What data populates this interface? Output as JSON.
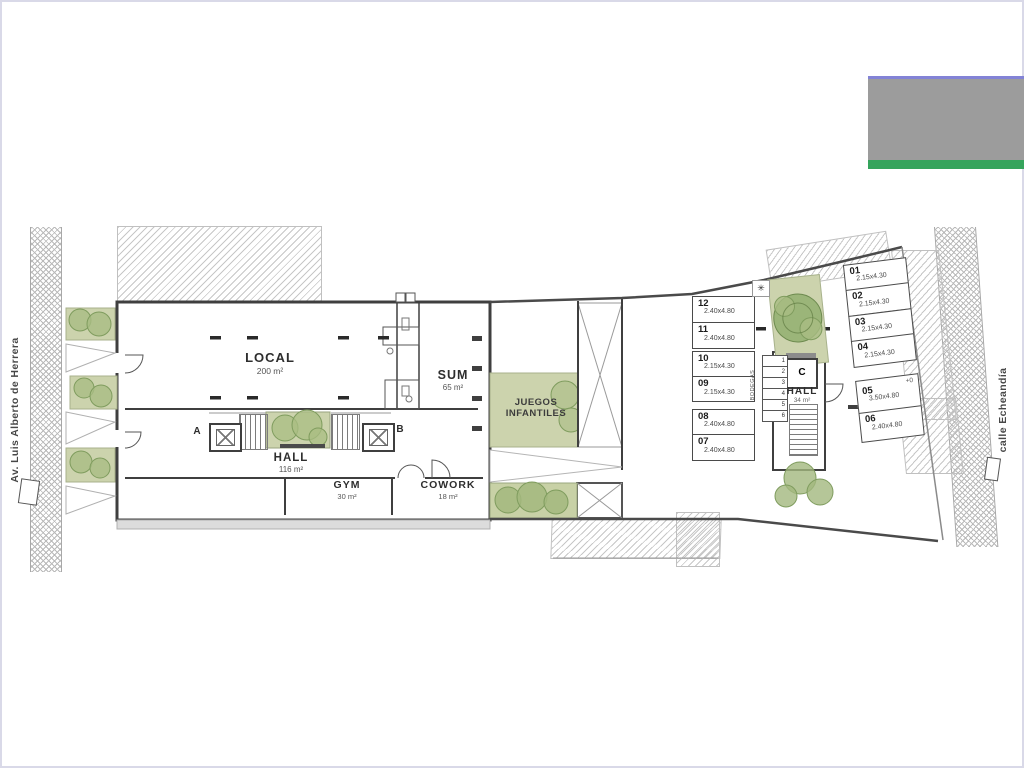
{
  "plan": {
    "streets": {
      "left_label": "Av. Luis Alberto de Herrera",
      "right_label": "calle Echeandía"
    },
    "rooms": {
      "local": {
        "label": "LOCAL",
        "area": "200 m²"
      },
      "sum": {
        "label": "SUM",
        "area": "65 m²"
      },
      "hall_main": {
        "label": "HALL",
        "area": "116 m²"
      },
      "gym": {
        "label": "GYM",
        "area": "30 m²"
      },
      "cowork": {
        "label": "COWORK",
        "area": "18 m²"
      },
      "playground": {
        "line1": "JUEGOS",
        "line2": "INFANTILES"
      },
      "hall_right": {
        "label": "HALL",
        "area": "34 m²"
      }
    },
    "elevators": {
      "a": "A",
      "b": "B",
      "c": "C"
    },
    "parking_left": [
      {
        "num": "12",
        "dim": "2.40x4.80"
      },
      {
        "num": "11",
        "dim": "2.40x4.80"
      },
      {
        "num": "10",
        "dim": "2.15x4.30"
      },
      {
        "num": "09",
        "dim": "2.15x4.30"
      },
      {
        "num": "08",
        "dim": "2.40x4.80"
      },
      {
        "num": "07",
        "dim": "2.40x4.80"
      }
    ],
    "parking_right": [
      {
        "num": "01",
        "dim": "2.15x4.30"
      },
      {
        "num": "02",
        "dim": "2.15x4.30"
      },
      {
        "num": "03",
        "dim": "2.15x4.30"
      },
      {
        "num": "04",
        "dim": "2.15x4.30"
      },
      {
        "num": "05",
        "dim": "3.50x4.80",
        "level": "+0"
      },
      {
        "num": "06",
        "dim": "2.40x4.80"
      }
    ],
    "storage": {
      "label": "BODEGAS",
      "units": [
        "1",
        "2",
        "3",
        "4",
        "5",
        "6"
      ]
    },
    "icons": {
      "light": "✳"
    },
    "colors": {
      "banner_green": "#35a45c",
      "banner_gray": "#9c9c9c",
      "banner_blue": "#8383d6",
      "plan_green": "#ccd3ad",
      "tree_green": "#a9bd83",
      "wall": "#3f3f3f"
    }
  }
}
